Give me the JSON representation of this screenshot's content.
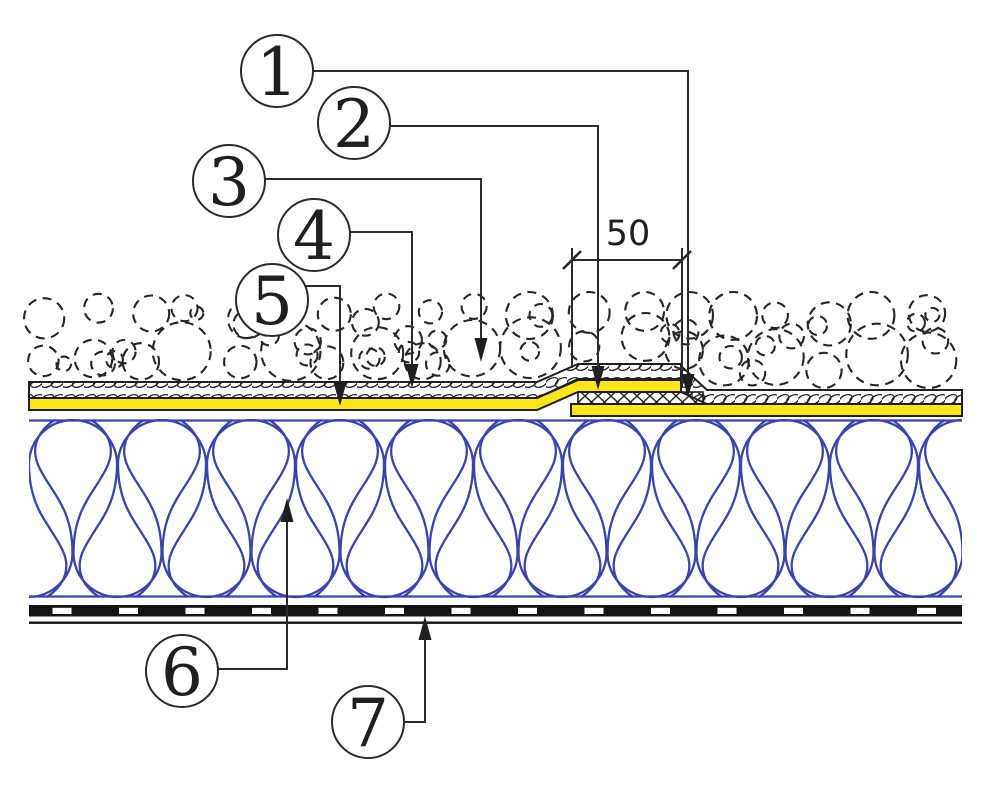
{
  "diagram": {
    "kind": "flat-roof construction detail section",
    "dimension_label": "50",
    "callouts": [
      {
        "label": "1"
      },
      {
        "label": "2"
      },
      {
        "label": "3"
      },
      {
        "label": "4"
      },
      {
        "label": "5"
      },
      {
        "label": "6"
      },
      {
        "label": "7"
      }
    ],
    "colors": {
      "line": "#2b2b2b",
      "membrane_yellow": "#fbe522",
      "insulation_blue": "#3b44a9",
      "barrier_black": "#141414"
    }
  }
}
